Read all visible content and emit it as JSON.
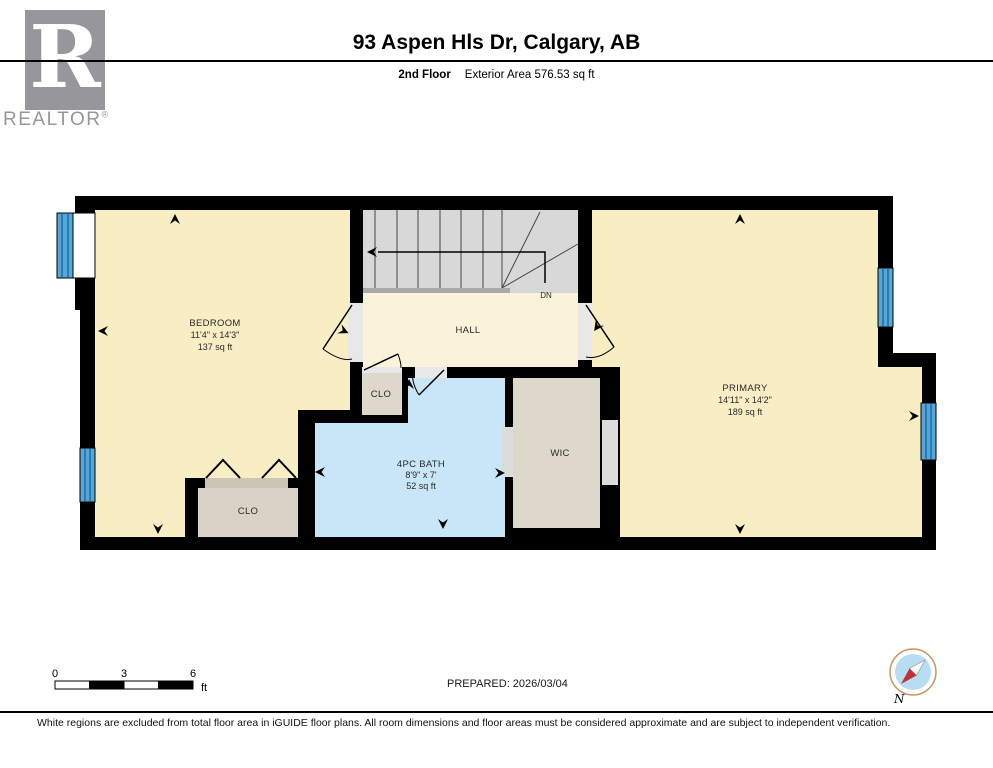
{
  "header": {
    "logo_letter": "R",
    "logo_brand": "REALTOR",
    "logo_reg": "®",
    "title": "93 Aspen Hls Dr, Calgary, AB",
    "floor_label": "2nd Floor",
    "area_label": "Exterior Area 576.53 sq ft"
  },
  "rooms": {
    "bedroom": {
      "name": "BEDROOM",
      "dims": "11'4\" x 14'3\"",
      "area": "137 sq ft"
    },
    "hall": {
      "name": "HALL"
    },
    "clo_upper": {
      "name": "CLO"
    },
    "bath": {
      "name": "4PC BATH",
      "dims": "8'9\" x 7'",
      "area": "52 sq ft"
    },
    "wic": {
      "name": "WIC"
    },
    "clo_lower": {
      "name": "CLO"
    },
    "primary": {
      "name": "PRIMARY",
      "dims": "14'11\" x 14'2\"",
      "area": "189 sq ft"
    }
  },
  "stairs": {
    "dn_label": "DN"
  },
  "scale_bar": {
    "ticks": [
      "0",
      "3",
      "6"
    ],
    "unit": "ft"
  },
  "prepared_label": "PREPARED: 2026/03/04",
  "compass": {
    "north_label": "N"
  },
  "footer": {
    "disclaimer": "White regions are excluded from total floor area in iGUIDE floor plans. All room dimensions and floor areas must be considered approximate and are subject to independent verification."
  },
  "colors": {
    "wall": "#000000",
    "room_cream": "#f8edc3",
    "hall_cream": "#faf3da",
    "bath_blue": "#c8e6f8",
    "closet_beige": "#ded8cb",
    "stairs_gray": "#d8d8d8",
    "window_blue": "#55a7d8",
    "compass_red": "#c62f35",
    "logo_gray": "#97969b"
  }
}
